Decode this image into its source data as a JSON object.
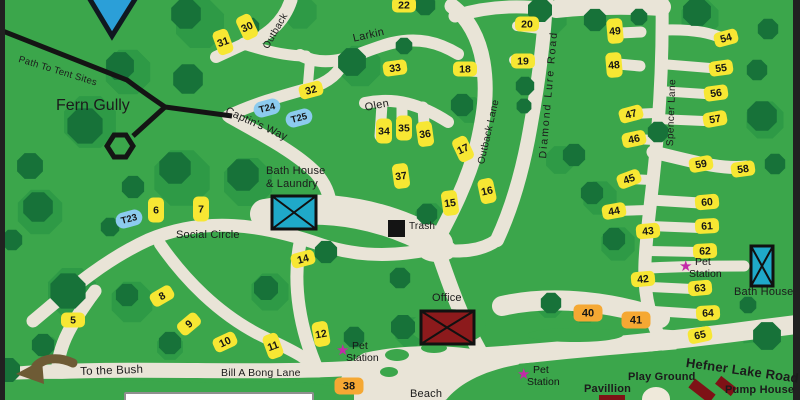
{
  "title": "Campground Map",
  "colors": {
    "background_green": "#3BA64B",
    "tree_green": "#177239",
    "bush_green": "#2E9A46",
    "road_beige": "#E9E4D7",
    "site_yellow": "#F7E733",
    "site_orange": "#F5A833",
    "tent_blue": "#8CCBEE",
    "building_teal": "#1FA9C9",
    "building_red": "#8C1A1C",
    "pump_red": "#7E1216",
    "pet_station_magenta": "#C32AA8",
    "trail_black": "#141414",
    "water_blue": "#2B9FD8",
    "arrow_brown": "#6E5B35"
  },
  "labels": [
    {
      "id": "path-to-tent-sites",
      "text": "Path To Tent Sites",
      "x": 20,
      "y": 55,
      "rot": 17,
      "size": 9.5,
      "w": 400,
      "ls": 0.3
    },
    {
      "id": "fern-gully",
      "text": "Fern Gully",
      "x": 56,
      "y": 98,
      "rot": 0,
      "size": 16,
      "w": 400,
      "ls": 0
    },
    {
      "id": "captins-way",
      "text": "Captin's Way",
      "x": 228,
      "y": 106,
      "rot": 24,
      "size": 11,
      "w": 400,
      "ls": 0.2
    },
    {
      "id": "social-circle",
      "text": "Social Circle",
      "x": 176,
      "y": 230,
      "rot": 0,
      "size": 11,
      "w": 400,
      "ls": 0.2
    },
    {
      "id": "larkin",
      "text": "Larkin",
      "x": 352,
      "y": 34,
      "rot": -13,
      "size": 11,
      "w": 400,
      "ls": 0.3
    },
    {
      "id": "olen",
      "text": "Olen",
      "x": 364,
      "y": 103,
      "rot": -11,
      "size": 11,
      "w": 400,
      "ls": 0.3
    },
    {
      "id": "outback-top",
      "text": "Outback",
      "x": 262,
      "y": 46,
      "rot": -60,
      "size": 10,
      "w": 400,
      "ls": 0.3
    },
    {
      "id": "outback-lane",
      "text": "Outback Lane",
      "x": 477,
      "y": 163,
      "rot": -77,
      "size": 10,
      "w": 400,
      "ls": 0.3
    },
    {
      "id": "diamond-lure-road",
      "text": "Diamond Lure Road",
      "x": 538,
      "y": 158,
      "rot": -85,
      "size": 10.5,
      "w": 400,
      "ls": 2
    },
    {
      "id": "spencer-lane",
      "text": "Spencer Lane",
      "x": 666,
      "y": 146,
      "rot": -88,
      "size": 10,
      "w": 400,
      "ls": 0.4
    },
    {
      "id": "hefner-lake-road",
      "text": "Hefner Lake Road",
      "x": 687,
      "y": 356,
      "rot": 8,
      "size": 13,
      "w": 600,
      "ls": 0.2
    },
    {
      "id": "bill-a-bong-lane",
      "text": "Bill A Bong Lane",
      "x": 221,
      "y": 368,
      "rot": 0,
      "size": 10.5,
      "w": 400,
      "ls": 0.2
    },
    {
      "id": "to-the-bush",
      "text": "To the Bush",
      "x": 80,
      "y": 366,
      "rot": -2,
      "size": 11.5,
      "w": 400,
      "ls": 0.2
    },
    {
      "id": "beach",
      "text": "Beach",
      "x": 410,
      "y": 389,
      "rot": 0,
      "size": 11,
      "w": 400,
      "ls": 0.2
    },
    {
      "id": "office",
      "text": "Office",
      "x": 432,
      "y": 293,
      "rot": 0,
      "size": 11,
      "w": 400,
      "ls": 0.2
    },
    {
      "id": "trash",
      "text": "Trash",
      "x": 409,
      "y": 222,
      "rot": 0,
      "size": 10,
      "w": 400,
      "ls": 0.2
    },
    {
      "id": "bath-house-laundry-line1",
      "text": "Bath House",
      "x": 266,
      "y": 166,
      "rot": 0,
      "size": 11,
      "w": 400,
      "ls": 0.2
    },
    {
      "id": "bath-house-laundry-line2",
      "text": "& Laundry",
      "x": 266,
      "y": 179,
      "rot": 0,
      "size": 11,
      "w": 400,
      "ls": 0.2
    },
    {
      "id": "bath-house-right",
      "text": "Bath House",
      "x": 734,
      "y": 287,
      "rot": 0,
      "size": 11,
      "w": 400,
      "ls": 0.2
    },
    {
      "id": "pavillion",
      "text": "Pavillion",
      "x": 584,
      "y": 384,
      "rot": 0,
      "size": 11,
      "w": 600,
      "ls": 0.2
    },
    {
      "id": "play-ground",
      "text": "Play Ground",
      "x": 628,
      "y": 372,
      "rot": 0,
      "size": 11,
      "w": 600,
      "ls": 0.2
    },
    {
      "id": "pump-house",
      "text": "Pump House",
      "x": 725,
      "y": 385,
      "rot": 0,
      "size": 11,
      "w": 600,
      "ls": 0.2
    }
  ],
  "pet_station_label": {
    "line1": "Pet",
    "line2": "Station"
  },
  "pet_stations": [
    {
      "id": "pet-station-center",
      "x": 338,
      "y": 340
    },
    {
      "id": "pet-station-beach",
      "x": 519,
      "y": 364
    },
    {
      "id": "pet-station-spencer",
      "x": 681,
      "y": 256
    }
  ],
  "sites": [
    {
      "n": "5",
      "x": 73,
      "y": 320,
      "o": "h",
      "r": 0,
      "c": "y"
    },
    {
      "n": "6",
      "x": 156,
      "y": 210,
      "o": "v",
      "r": 0,
      "c": "y"
    },
    {
      "n": "7",
      "x": 201,
      "y": 209,
      "o": "v",
      "r": 0,
      "c": "y"
    },
    {
      "n": "8",
      "x": 162,
      "y": 296,
      "o": "h",
      "r": -30,
      "c": "y"
    },
    {
      "n": "9",
      "x": 189,
      "y": 324,
      "o": "h",
      "r": -40,
      "c": "y"
    },
    {
      "n": "10",
      "x": 225,
      "y": 342,
      "o": "h",
      "r": -25,
      "c": "y"
    },
    {
      "n": "11",
      "x": 273,
      "y": 346,
      "o": "v",
      "r": -20,
      "c": "y"
    },
    {
      "n": "12",
      "x": 321,
      "y": 334,
      "o": "v",
      "r": -10,
      "c": "y"
    },
    {
      "n": "14",
      "x": 303,
      "y": 259,
      "o": "h",
      "r": -15,
      "c": "y"
    },
    {
      "n": "15",
      "x": 450,
      "y": 203,
      "o": "v",
      "r": -8,
      "c": "y"
    },
    {
      "n": "16",
      "x": 487,
      "y": 191,
      "o": "v",
      "r": -12,
      "c": "y"
    },
    {
      "n": "17",
      "x": 463,
      "y": 149,
      "o": "v",
      "r": -25,
      "c": "y"
    },
    {
      "n": "18",
      "x": 465,
      "y": 69,
      "o": "h",
      "r": 0,
      "c": "y"
    },
    {
      "n": "19",
      "x": 523,
      "y": 61,
      "o": "h",
      "r": 0,
      "c": "y"
    },
    {
      "n": "20",
      "x": 527,
      "y": 24,
      "o": "h",
      "r": 0,
      "c": "y"
    },
    {
      "n": "22",
      "x": 404,
      "y": 5,
      "o": "h",
      "r": 0,
      "c": "y"
    },
    {
      "n": "30",
      "x": 247,
      "y": 27,
      "o": "v",
      "r": -25,
      "c": "y"
    },
    {
      "n": "31",
      "x": 223,
      "y": 42,
      "o": "v",
      "r": -20,
      "c": "y"
    },
    {
      "n": "32",
      "x": 311,
      "y": 90,
      "o": "h",
      "r": -15,
      "c": "y"
    },
    {
      "n": "33",
      "x": 395,
      "y": 68,
      "o": "h",
      "r": -8,
      "c": "y"
    },
    {
      "n": "34",
      "x": 384,
      "y": 131,
      "o": "v",
      "r": 0,
      "c": "y"
    },
    {
      "n": "35",
      "x": 404,
      "y": 128,
      "o": "v",
      "r": 0,
      "c": "y"
    },
    {
      "n": "36",
      "x": 425,
      "y": 134,
      "o": "v",
      "r": -8,
      "c": "y"
    },
    {
      "n": "37",
      "x": 401,
      "y": 176,
      "o": "v",
      "r": -8,
      "c": "y"
    },
    {
      "n": "38",
      "x": 349,
      "y": 386,
      "o": "h",
      "r": 0,
      "c": "o",
      "big": true
    },
    {
      "n": "40",
      "x": 588,
      "y": 313,
      "o": "h",
      "r": 0,
      "c": "o",
      "big": true
    },
    {
      "n": "41",
      "x": 636,
      "y": 320,
      "o": "h",
      "r": 0,
      "c": "o",
      "big": true
    },
    {
      "n": "42",
      "x": 643,
      "y": 279,
      "o": "h",
      "r": -5,
      "c": "y"
    },
    {
      "n": "43",
      "x": 648,
      "y": 231,
      "o": "h",
      "r": -5,
      "c": "y"
    },
    {
      "n": "44",
      "x": 614,
      "y": 211,
      "o": "h",
      "r": -10,
      "c": "y"
    },
    {
      "n": "45",
      "x": 629,
      "y": 179,
      "o": "h",
      "r": -20,
      "c": "y"
    },
    {
      "n": "46",
      "x": 634,
      "y": 139,
      "o": "h",
      "r": -12,
      "c": "y"
    },
    {
      "n": "47",
      "x": 631,
      "y": 114,
      "o": "h",
      "r": -15,
      "c": "y"
    },
    {
      "n": "48",
      "x": 614,
      "y": 65,
      "o": "v",
      "r": -5,
      "c": "y"
    },
    {
      "n": "49",
      "x": 615,
      "y": 31,
      "o": "v",
      "r": -5,
      "c": "y"
    },
    {
      "n": "54",
      "x": 726,
      "y": 38,
      "o": "h",
      "r": -15,
      "c": "y"
    },
    {
      "n": "55",
      "x": 721,
      "y": 68,
      "o": "h",
      "r": -8,
      "c": "y"
    },
    {
      "n": "56",
      "x": 716,
      "y": 93,
      "o": "h",
      "r": -8,
      "c": "y"
    },
    {
      "n": "57",
      "x": 715,
      "y": 119,
      "o": "h",
      "r": -10,
      "c": "y"
    },
    {
      "n": "58",
      "x": 743,
      "y": 169,
      "o": "h",
      "r": -8,
      "c": "y"
    },
    {
      "n": "59",
      "x": 701,
      "y": 164,
      "o": "h",
      "r": -10,
      "c": "y"
    },
    {
      "n": "60",
      "x": 707,
      "y": 202,
      "o": "h",
      "r": -5,
      "c": "y"
    },
    {
      "n": "61",
      "x": 707,
      "y": 226,
      "o": "h",
      "r": -3,
      "c": "y"
    },
    {
      "n": "62",
      "x": 705,
      "y": 251,
      "o": "h",
      "r": -3,
      "c": "y"
    },
    {
      "n": "63",
      "x": 700,
      "y": 288,
      "o": "h",
      "r": -5,
      "c": "y"
    },
    {
      "n": "64",
      "x": 708,
      "y": 313,
      "o": "h",
      "r": -3,
      "c": "y"
    },
    {
      "n": "65",
      "x": 700,
      "y": 335,
      "o": "h",
      "r": -12,
      "c": "y"
    }
  ],
  "tent_sites": [
    {
      "n": "T23",
      "x": 129,
      "y": 219,
      "r": -15
    },
    {
      "n": "T24",
      "x": 267,
      "y": 108,
      "r": -15
    },
    {
      "n": "T25",
      "x": 299,
      "y": 118,
      "r": -15
    }
  ],
  "trees": [
    [
      186,
      14,
      16
    ],
    [
      250,
      27,
      10
    ],
    [
      425,
      5,
      11
    ],
    [
      540,
      10,
      13
    ],
    [
      595,
      20,
      12
    ],
    [
      639,
      17,
      9
    ],
    [
      697,
      12,
      15
    ],
    [
      768,
      29,
      11
    ],
    [
      120,
      66,
      15
    ],
    [
      188,
      79,
      16
    ],
    [
      352,
      62,
      15
    ],
    [
      404,
      46,
      9
    ],
    [
      462,
      105,
      12
    ],
    [
      525,
      86,
      10
    ],
    [
      524,
      106,
      8
    ],
    [
      757,
      70,
      11
    ],
    [
      762,
      116,
      16
    ],
    [
      775,
      164,
      11
    ],
    [
      658,
      132,
      11
    ],
    [
      85,
      126,
      19
    ],
    [
      30,
      166,
      14
    ],
    [
      175,
      168,
      17
    ],
    [
      243,
      175,
      17
    ],
    [
      133,
      187,
      12
    ],
    [
      110,
      227,
      10
    ],
    [
      38,
      207,
      16
    ],
    [
      12,
      240,
      11
    ],
    [
      326,
      252,
      12
    ],
    [
      427,
      214,
      11
    ],
    [
      574,
      155,
      12
    ],
    [
      592,
      193,
      12
    ],
    [
      614,
      239,
      12
    ],
    [
      68,
      291,
      19
    ],
    [
      127,
      295,
      12
    ],
    [
      266,
      288,
      13
    ],
    [
      400,
      278,
      11
    ],
    [
      403,
      327,
      13
    ],
    [
      354,
      337,
      11
    ],
    [
      43,
      345,
      12
    ],
    [
      170,
      343,
      12
    ],
    [
      8,
      370,
      13
    ],
    [
      551,
      303,
      11
    ],
    [
      748,
      305,
      9
    ],
    [
      767,
      336,
      15
    ]
  ],
  "bushes": [
    [
      200,
      24,
      26
    ],
    [
      300,
      12,
      18
    ],
    [
      550,
      18,
      18
    ],
    [
      700,
      18,
      20
    ],
    [
      128,
      72,
      24
    ],
    [
      90,
      122,
      28
    ],
    [
      360,
      66,
      22
    ],
    [
      470,
      110,
      14
    ],
    [
      182,
      178,
      30
    ],
    [
      248,
      182,
      26
    ],
    [
      40,
      212,
      24
    ],
    [
      765,
      120,
      20
    ],
    [
      600,
      198,
      18
    ],
    [
      618,
      244,
      18
    ],
    [
      560,
      160,
      15
    ],
    [
      430,
      218,
      16
    ],
    [
      72,
      292,
      26
    ],
    [
      132,
      302,
      22
    ],
    [
      270,
      292,
      20
    ],
    [
      410,
      332,
      16
    ],
    [
      550,
      305,
      14
    ],
    [
      585,
      310,
      14
    ],
    [
      760,
      342,
      18
    ],
    [
      170,
      347,
      14
    ],
    [
      48,
      348,
      12
    ]
  ]
}
